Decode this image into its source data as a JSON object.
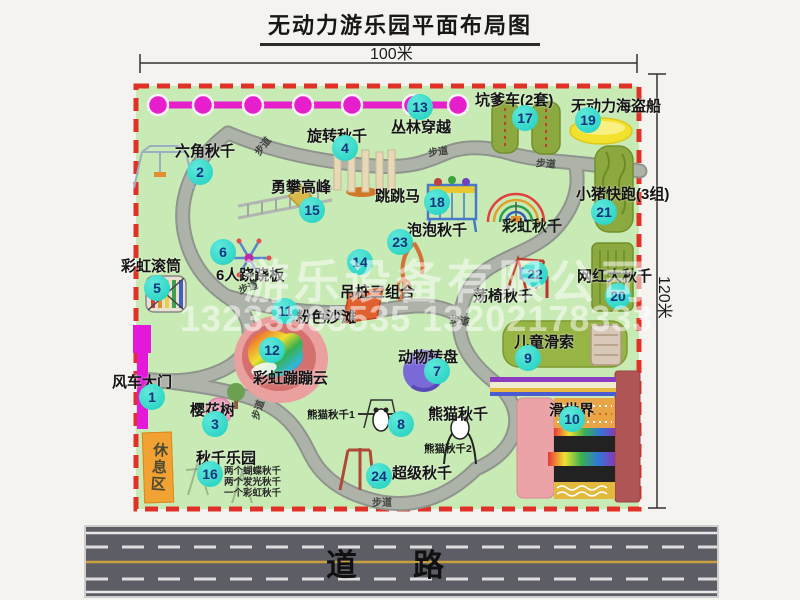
{
  "title": "无动力游乐园平面布局图",
  "dimensions": {
    "width_label": "100米",
    "height_label": "120米"
  },
  "road": {
    "label": "道路"
  },
  "watermark": {
    "company": "游乐设备有限公司",
    "phone": "13233805535 13202178333"
  },
  "rest_area": {
    "label": "休息区"
  },
  "path_label_text": "步道",
  "path_labels": [
    {
      "x": 252,
      "y": 138,
      "r": -52
    },
    {
      "x": 428,
      "y": 143,
      "r": -8
    },
    {
      "x": 536,
      "y": 155,
      "r": 4
    },
    {
      "x": 238,
      "y": 279,
      "r": -18
    },
    {
      "x": 247,
      "y": 402,
      "r": -72
    },
    {
      "x": 372,
      "y": 494,
      "r": 0
    },
    {
      "x": 450,
      "y": 312,
      "r": 8
    }
  ],
  "extra_labels": [
    {
      "text": "彩虹秋千",
      "x": 502,
      "y": 215,
      "size": 15
    },
    {
      "text": "熊猫秋千1",
      "x": 307,
      "y": 407,
      "size": 10.5
    },
    {
      "text": "熊猫秋千2",
      "x": 424,
      "y": 441,
      "size": 10.5
    }
  ],
  "swing_park_notes": [
    "两个蝴蝶秋千",
    "两个发光秋千",
    "一个彩虹秋千"
  ],
  "attractions": [
    {
      "num": "1",
      "name": "风车大门",
      "badge": [
        152,
        397
      ],
      "label": [
        112,
        371
      ]
    },
    {
      "num": "2",
      "name": "六角秋千",
      "badge": [
        200,
        172
      ],
      "label": [
        175,
        140
      ]
    },
    {
      "num": "3",
      "name": "樱花树",
      "badge": [
        215,
        424
      ],
      "label": [
        190,
        399
      ]
    },
    {
      "num": "4",
      "name": "旋转秋千",
      "badge": [
        345,
        148
      ],
      "label": [
        307,
        125
      ]
    },
    {
      "num": "5",
      "name": "彩虹滚筒",
      "badge": [
        157,
        288
      ],
      "label": [
        121,
        255
      ]
    },
    {
      "num": "6",
      "name": "6人跷跷板",
      "badge": [
        223,
        252
      ],
      "label": [
        216,
        264
      ]
    },
    {
      "num": "7",
      "name": "动物转盘",
      "badge": [
        437,
        371
      ],
      "label": [
        398,
        346
      ]
    },
    {
      "num": "8",
      "name": "熊猫秋千",
      "badge": [
        401,
        424
      ],
      "label": [
        428,
        403
      ]
    },
    {
      "num": "9",
      "name": "儿童滑索",
      "badge": [
        528,
        358
      ],
      "label": [
        514,
        331
      ]
    },
    {
      "num": "10",
      "name": "滑世界",
      "badge": [
        572,
        419
      ],
      "label": [
        549,
        399
      ]
    },
    {
      "num": "11",
      "name": "粉色沙滩",
      "badge": [
        285,
        311
      ],
      "label": [
        296,
        306
      ]
    },
    {
      "num": "12",
      "name": "彩虹蹦蹦云",
      "badge": [
        272,
        350
      ],
      "label": [
        253,
        367
      ]
    },
    {
      "num": "13",
      "name": "丛林穿越",
      "badge": [
        420,
        107
      ],
      "label": [
        391,
        116
      ]
    },
    {
      "num": "14",
      "name": "吊桩三组合",
      "badge": [
        360,
        262
      ],
      "label": [
        340,
        281
      ]
    },
    {
      "num": "15",
      "name": "勇攀高峰",
      "badge": [
        312,
        210
      ],
      "label": [
        271,
        176
      ]
    },
    {
      "num": "16",
      "name": "秋千乐园",
      "badge": [
        210,
        474
      ],
      "label": [
        196,
        447
      ]
    },
    {
      "num": "17",
      "name": "坑爹车(2套)",
      "badge": [
        525,
        118
      ],
      "label": [
        475,
        89
      ]
    },
    {
      "num": "18",
      "name": "跳跳马",
      "badge": [
        437,
        202
      ],
      "label": [
        375,
        185
      ]
    },
    {
      "num": "19",
      "name": "无动力海盗船",
      "badge": [
        588,
        120
      ],
      "label": [
        571,
        95
      ]
    },
    {
      "num": "20",
      "name": "网红大秋千",
      "badge": [
        618,
        296
      ],
      "label": [
        577,
        265
      ]
    },
    {
      "num": "21",
      "name": "小猪快跑(3组)",
      "badge": [
        604,
        212
      ],
      "label": [
        576,
        183
      ]
    },
    {
      "num": "22",
      "name": "荡椅秋千",
      "badge": [
        535,
        274
      ],
      "label": [
        473,
        285
      ]
    },
    {
      "num": "23",
      "name": "泡泡秋千",
      "badge": [
        400,
        242
      ],
      "label": [
        407,
        219
      ]
    },
    {
      "num": "24",
      "name": "超级秋千",
      "badge": [
        379,
        476
      ],
      "label": [
        392,
        462
      ]
    }
  ],
  "colors": {
    "park_green": "#c8eab4",
    "border_red": "#e03027",
    "badge_teal": "#2fd6c6",
    "chain_magenta": "#e61ecb",
    "road_gray": "#5d5d66",
    "equipment_olive": "#8ca93f",
    "rest_orange": "#f2a133"
  }
}
